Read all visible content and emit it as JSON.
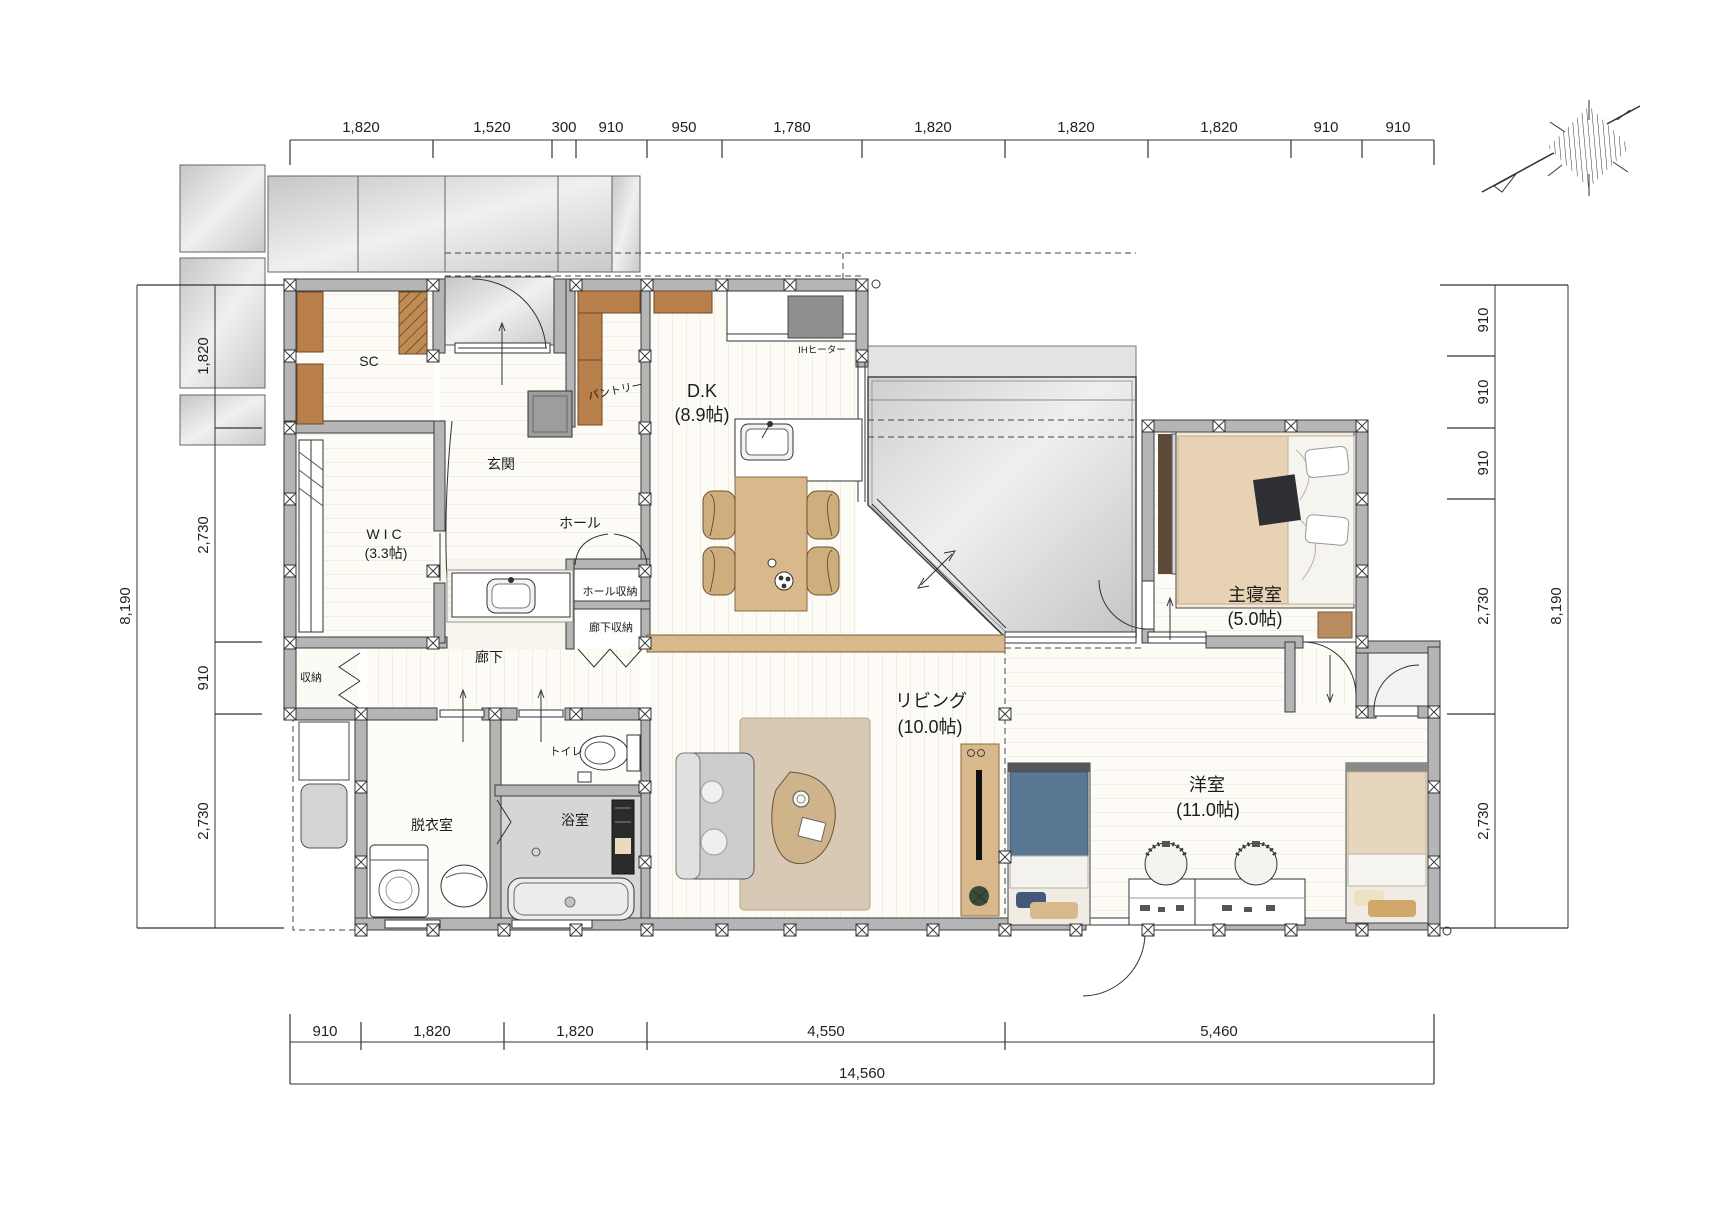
{
  "title": "1F間取り図 (floor plan)",
  "colors": {
    "wall": "#b5b5b5",
    "wood_accent": "#d9b98c",
    "cabinet_brown": "#b9804c",
    "balcony_gray": "#d9d9d9",
    "floor_warm_white": "#fcfbf5",
    "bed_blue": "#5a7894",
    "bed_beige": "#e8d2b4"
  },
  "dims": {
    "top": [
      "1,820",
      "1,520",
      "300",
      "910",
      "950",
      "1,780",
      "1,820",
      "1,820",
      "1,820",
      "910",
      "910"
    ],
    "bottom": [
      "910",
      "1,820",
      "1,820",
      "4,550",
      "5,460"
    ],
    "bottom_total": "14,560",
    "left": [
      "1,820",
      "2,730",
      "910",
      "2,730"
    ],
    "left_total": "8,190",
    "right": [
      "910",
      "910",
      "910",
      "2,730",
      "2,730"
    ],
    "right_total": "8,190"
  },
  "rooms": {
    "sc": {
      "name": "SC"
    },
    "genkan": {
      "name": "玄関"
    },
    "wic": {
      "name": "WIC",
      "size": "(3.3帖)"
    },
    "pantry": {
      "name": "パントリー"
    },
    "dk": {
      "name": "D.K",
      "size": "(8.9帖)"
    },
    "ih": {
      "name": "IHヒーター"
    },
    "hall": {
      "name": "ホール"
    },
    "hall_storage": {
      "name": "ホール収納"
    },
    "corridor_storage": {
      "name": "廊下収納"
    },
    "corridor": {
      "name": "廊下"
    },
    "storage": {
      "name": "収納"
    },
    "toilet": {
      "name": "トイレ"
    },
    "dressing": {
      "name": "脱衣室"
    },
    "bath": {
      "name": "浴室"
    },
    "living": {
      "name": "リビング",
      "size": "(10.0帖)"
    },
    "master": {
      "name": "主寝室",
      "size": "(5.0帖)"
    },
    "western": {
      "name": "洋室",
      "size": "(11.0帖)"
    }
  }
}
